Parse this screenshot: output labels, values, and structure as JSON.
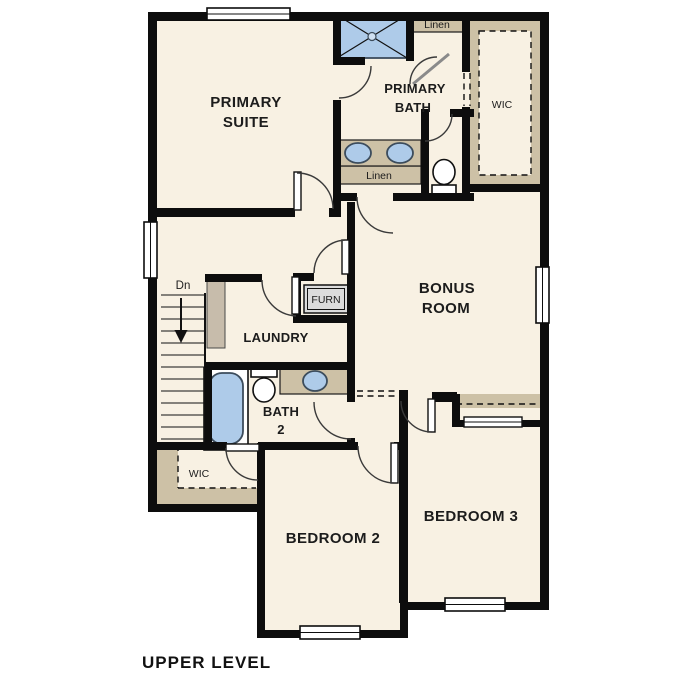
{
  "title": {
    "text": "UPPER LEVEL"
  },
  "colors": {
    "floor": "#f8f1e3",
    "shelving_tan": "#cdc1a6",
    "fixture_blue": "#aecbe9",
    "wall_black": "#0d0d0d"
  },
  "rooms": {
    "primary_suite": {
      "line1": "PRIMARY",
      "line2": "SUITE"
    },
    "primary_bath": {
      "line1": "PRIMARY",
      "line2": "BATH"
    },
    "bonus_room": {
      "line1": "BONUS",
      "line2": "ROOM"
    },
    "laundry": {
      "label": "LAUNDRY"
    },
    "bath2": {
      "line1": "BATH",
      "line2": "2"
    },
    "bedroom2": {
      "label": "BEDROOM 2"
    },
    "bedroom3": {
      "label": "BEDROOM 3"
    },
    "wic_upper": {
      "label": "WIC"
    },
    "wic_lower": {
      "label": "WIC"
    },
    "linen_upper": {
      "label": "Linen"
    },
    "linen_hall": {
      "label": "Linen"
    },
    "furnace_closet": {
      "label": "FURN"
    },
    "stairs": {
      "direction_label": "Dn"
    }
  }
}
